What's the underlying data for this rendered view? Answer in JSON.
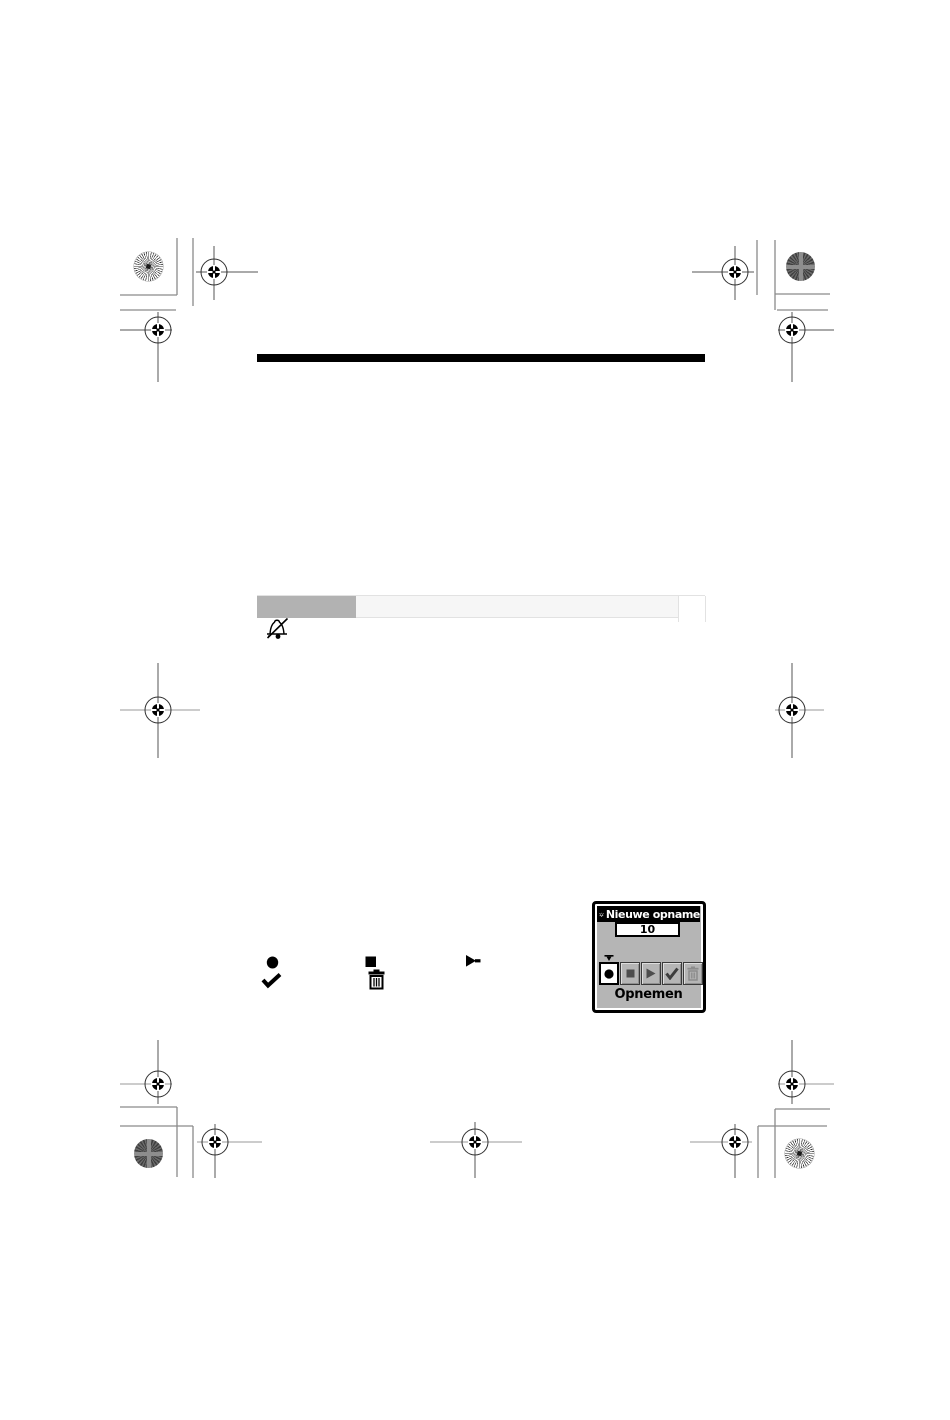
{
  "dialog": {
    "title": "Nieuwe opname",
    "title_icon": "alarm-bell-icon",
    "field_value": "10",
    "action_label": "Opnemen",
    "buttons": [
      {
        "name": "record",
        "icon": "record-icon",
        "state": "selected"
      },
      {
        "name": "stop",
        "icon": "stop-icon",
        "state": "default"
      },
      {
        "name": "play",
        "icon": "play-icon",
        "state": "default"
      },
      {
        "name": "confirm",
        "icon": "check-icon",
        "state": "default"
      },
      {
        "name": "delete",
        "icon": "trash-icon",
        "state": "disabled"
      }
    ],
    "colors": {
      "title_bar": "#000000",
      "title_text": "#ffffff",
      "body": "#b5b5b5",
      "selected_button_bg": "#ffffff"
    }
  },
  "inline_symbols": [
    {
      "icon": "record-icon"
    },
    {
      "icon": "check-icon"
    },
    {
      "icon": "stop-icon"
    },
    {
      "icon": "trash-icon"
    },
    {
      "icon": "play-icon"
    },
    {
      "icon": "bell-slash-icon"
    }
  ],
  "header_row": {
    "highlight_fill": "#b2b2b2",
    "row_fill": "#f6f6f6"
  },
  "divider_rule": {
    "color": "#000000"
  },
  "print_marks": {
    "registration_target_count": 11,
    "starburst_patch_count": 2,
    "texture_patch_count": 2
  }
}
